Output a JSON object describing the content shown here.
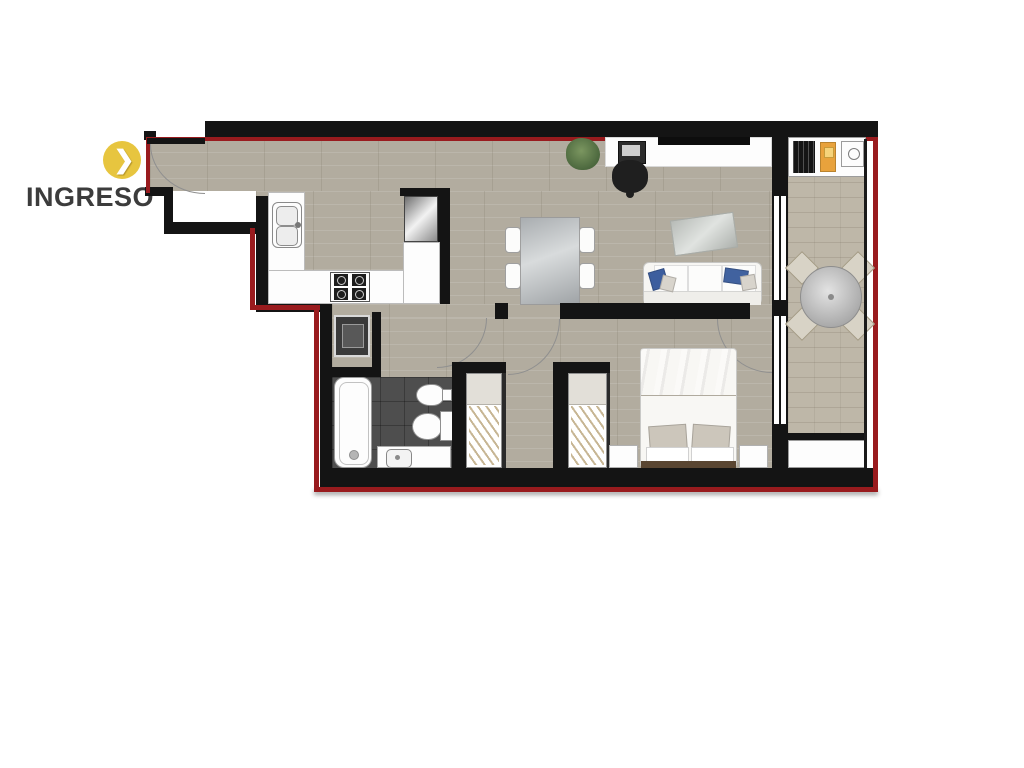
{
  "page": {
    "background_color": "#FFFFFF"
  },
  "entry_label": {
    "text": "INGRESO",
    "icon": "chevron-right-circle-icon",
    "icon_glyph": "❯",
    "icon_bg_color": "#E7C53F",
    "icon_glyph_color": "#FFFFFF",
    "text_color": "#3C3C3C"
  },
  "floorplan": {
    "type": "apartment-floor-plan",
    "boundary": {
      "wall_color": "#141414",
      "outline_color": "#991B1E"
    },
    "floors": {
      "main_color": "#B2AC9F",
      "balcony_color": "#BEB7A8",
      "bathroom_color": "#4E4E4E"
    },
    "rooms": [
      {
        "name": "entry-corridor",
        "furniture": [
          "entry-door"
        ]
      },
      {
        "name": "kitchen",
        "furniture": [
          "counter",
          "kitchen-sink",
          "stove",
          "refrigerator"
        ]
      },
      {
        "name": "living-dining",
        "furniture": [
          "dining-table",
          "dining-chairs",
          "sofa",
          "rug",
          "desk",
          "laptop",
          "tv",
          "office-chair",
          "plant"
        ]
      },
      {
        "name": "laundry",
        "furniture": [
          "washing-machine"
        ]
      },
      {
        "name": "bathroom",
        "furniture": [
          "bathtub",
          "bidet",
          "toilet",
          "vanity-sink"
        ]
      },
      {
        "name": "hallway",
        "furniture": [
          "closet"
        ]
      },
      {
        "name": "bedroom",
        "furniture": [
          "double-bed",
          "nightstand-left",
          "nightstand-right",
          "closet"
        ]
      },
      {
        "name": "balcony",
        "furniture": [
          "bbq-grill",
          "tray",
          "outdoor-sink",
          "round-table",
          "outdoor-chairs",
          "planter"
        ]
      }
    ]
  }
}
